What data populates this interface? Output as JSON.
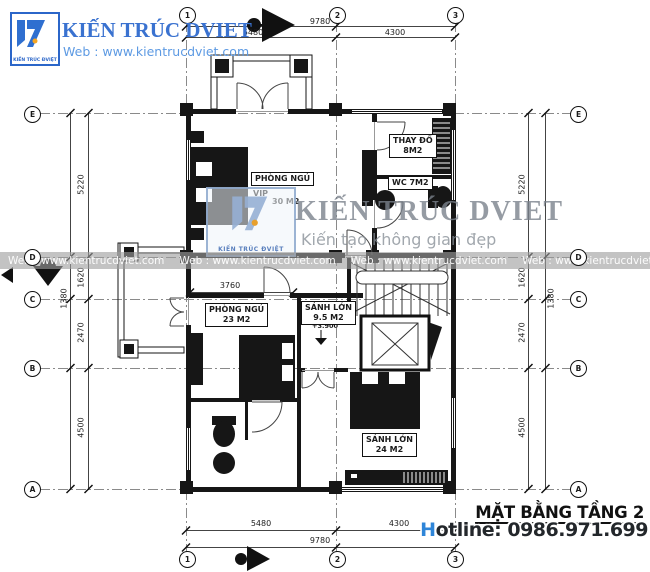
{
  "brand": {
    "name": "KIẾN TRÚC DVIET",
    "website": "Web : www.kientrucdviet.com",
    "logo_caption": "KIẾN TRÚC ĐVIỆT"
  },
  "watermark": {
    "name": "KIẾN TRÚC DVIET",
    "tagline": "Kiến tạo không gian đẹp",
    "band_text": "Web : www.kientrucdviet.com",
    "logo_caption": "KIẾN TRÚC ĐVIỆT"
  },
  "title_block": {
    "title": "MẶT BẰNG TẦNG 2",
    "hotline": "Hotline: 0986.971.699"
  },
  "grid": {
    "cols": [
      "1",
      "2",
      "3"
    ],
    "rows": [
      "E",
      "D",
      "C",
      "B",
      "A"
    ]
  },
  "dimensions": {
    "top": {
      "overall": "9780",
      "seg1": "5480",
      "seg2": "4300"
    },
    "bottom": {
      "overall": "9780",
      "seg1": "5480",
      "seg2": "4300"
    },
    "left": {
      "seg1": "5220",
      "seg2": "1620",
      "seg3": "2470",
      "seg4": "4500",
      "aux": "1380"
    },
    "right": {
      "seg1": "5220",
      "seg2": "1620",
      "seg3": "2470",
      "seg4": "4500",
      "aux": "1380"
    },
    "interior": {
      "bedroom_width": "3760"
    },
    "level": "+3.900"
  },
  "rooms": {
    "vip": {
      "name": "PHÒNG NGỦ",
      "suffix": "VIP",
      "area": "30 M2"
    },
    "changing": {
      "name": "THAY ĐỒ",
      "area": "8M2"
    },
    "wc": {
      "name": "WC 7M2"
    },
    "bedroom2": {
      "name": "PHÒNG NGỦ",
      "area": "23 M2"
    },
    "hall_small": {
      "name": "SẢNH LỚN",
      "area": "9.5 M2"
    },
    "hall_large": {
      "name": "SẢNH LỚN",
      "area": "24 M2"
    }
  },
  "colors": {
    "brand_blue": "#3a72d0",
    "link_blue": "#5d9ae3",
    "hotline_blue": "#2e85d8",
    "wall_black": "#161616",
    "watermark_gray": "#7a828c"
  }
}
